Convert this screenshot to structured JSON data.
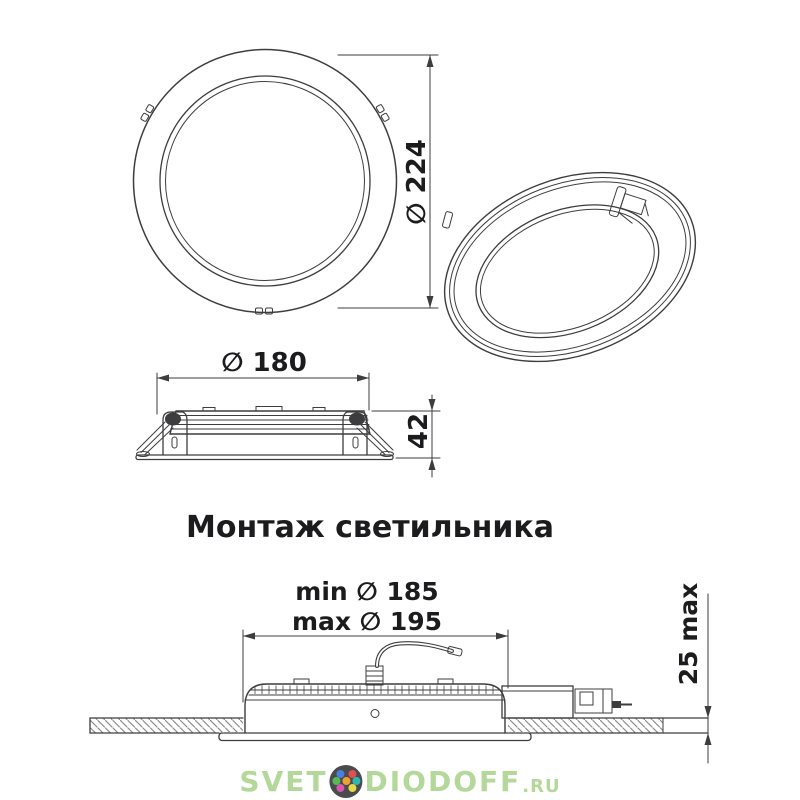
{
  "drawing": {
    "line_color": "#3d3d3f",
    "hatch_color": "#8f8f91",
    "background": "#ffffff"
  },
  "labels": {
    "front_diameter": "∅ 224",
    "side_diameter": "∅ 180",
    "side_height": "42",
    "mounting_title": "Монтаж светильника",
    "hole_min": "min ∅ 185",
    "hole_max": "max ∅ 195",
    "ceiling_depth": "25 max"
  },
  "watermark": {
    "part1": "SVET",
    "part2": "DIODOFF",
    "suffix": ".RU",
    "text_color": "#b3d89a",
    "logo_bg": "#4a4b4d",
    "logo_dot_colors": [
      "#4a7ee0",
      "#e05050",
      "#58b858",
      "#f0a030",
      "#30b8b0",
      "#d858b0",
      "#e8d84a"
    ]
  }
}
